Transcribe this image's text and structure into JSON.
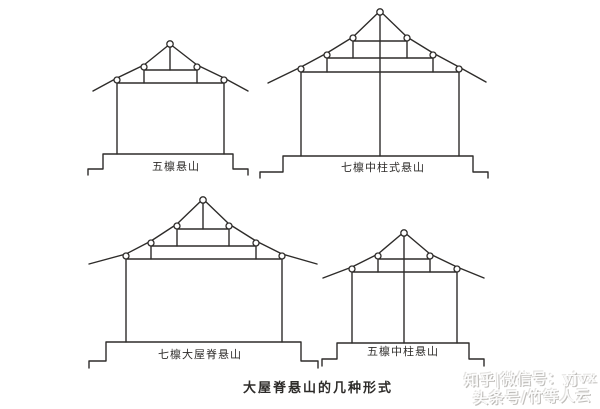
{
  "page": {
    "background": "#ffffff",
    "ink_color": "#2e2c2a",
    "title": "大屋脊悬山的几种形式"
  },
  "watermark": {
    "line1": "知乎|微信号：yjvx",
    "line2": "头条号/竹等人云"
  },
  "figures": [
    {
      "id": "five-purlin-gable",
      "label": "五檩悬山",
      "polylines": [
        {
          "name": "left-rafter",
          "points": [
            [
              93,
              91
            ],
            [
              117,
              78
            ],
            [
              144,
              65
            ],
            [
              170,
              44
            ]
          ]
        },
        {
          "name": "right-rafter",
          "points": [
            [
              170,
              44
            ],
            [
              197,
              65
            ],
            [
              224,
              78
            ],
            [
              248,
              91
            ]
          ]
        },
        {
          "name": "king-post",
          "points": [
            [
              170,
              47
            ],
            [
              170,
              70
            ]
          ]
        },
        {
          "name": "upper-beam",
          "points": [
            [
              144,
              70
            ],
            [
              197,
              70
            ]
          ]
        },
        {
          "name": "upper-post-left",
          "points": [
            [
              144,
              70
            ],
            [
              144,
              83
            ]
          ]
        },
        {
          "name": "upper-post-right",
          "points": [
            [
              197,
              70
            ],
            [
              197,
              83
            ]
          ]
        },
        {
          "name": "main-beam",
          "points": [
            [
              117,
              83
            ],
            [
              224,
              83
            ]
          ]
        },
        {
          "name": "column-left",
          "points": [
            [
              117,
              83
            ],
            [
              117,
              154
            ]
          ]
        },
        {
          "name": "column-right",
          "points": [
            [
              224,
              83
            ],
            [
              224,
              154
            ]
          ]
        },
        {
          "name": "plinth",
          "points": [
            [
              88,
              175
            ],
            [
              88,
              169
            ],
            [
              103,
              169
            ],
            [
              103,
              154
            ],
            [
              233,
              154
            ],
            [
              233,
              169
            ],
            [
              248,
              169
            ],
            [
              248,
              175
            ]
          ]
        }
      ],
      "circles": [
        [
          170,
          44,
          3.2
        ],
        [
          144,
          67,
          3
        ],
        [
          197,
          67,
          3
        ],
        [
          117,
          80,
          3
        ],
        [
          224,
          80,
          3
        ]
      ]
    },
    {
      "id": "seven-purlin-center-column-gable",
      "label": "七檩中柱式悬山",
      "polylines": [
        {
          "name": "left-rafter",
          "points": [
            [
              268,
              83
            ],
            [
              301,
              67
            ],
            [
              327,
              53
            ],
            [
              353,
              37
            ],
            [
              380,
              11
            ]
          ]
        },
        {
          "name": "right-rafter",
          "points": [
            [
              380,
              11
            ],
            [
              407,
              37
            ],
            [
              433,
              53
            ],
            [
              459,
              67
            ],
            [
              486,
              82
            ]
          ]
        },
        {
          "name": "center-column",
          "points": [
            [
              380,
              14
            ],
            [
              380,
              156
            ]
          ]
        },
        {
          "name": "upper-beam",
          "points": [
            [
              353,
              41
            ],
            [
              407,
              41
            ]
          ]
        },
        {
          "name": "upper-post-left",
          "points": [
            [
              353,
              41
            ],
            [
              353,
              58
            ]
          ]
        },
        {
          "name": "upper-post-right",
          "points": [
            [
              407,
              41
            ],
            [
              407,
              58
            ]
          ]
        },
        {
          "name": "middle-beam",
          "points": [
            [
              327,
              58
            ],
            [
              433,
              58
            ]
          ]
        },
        {
          "name": "middle-post-left",
          "points": [
            [
              327,
              58
            ],
            [
              327,
              72
            ]
          ]
        },
        {
          "name": "middle-post-right",
          "points": [
            [
              433,
              58
            ],
            [
              433,
              72
            ]
          ]
        },
        {
          "name": "main-beam",
          "points": [
            [
              301,
              72
            ],
            [
              459,
              72
            ]
          ]
        },
        {
          "name": "column-left",
          "points": [
            [
              301,
              72
            ],
            [
              301,
              156
            ]
          ]
        },
        {
          "name": "column-right",
          "points": [
            [
              459,
              72
            ],
            [
              459,
              156
            ]
          ]
        },
        {
          "name": "plinth",
          "points": [
            [
              260,
              178
            ],
            [
              260,
              172
            ],
            [
              283,
              172
            ],
            [
              283,
              156
            ],
            [
              473,
              156
            ],
            [
              473,
              172
            ],
            [
              488,
              172
            ],
            [
              488,
              178
            ]
          ]
        }
      ],
      "circles": [
        [
          380,
          12,
          3.2
        ],
        [
          353,
          38,
          3
        ],
        [
          407,
          38,
          3
        ],
        [
          327,
          55,
          3
        ],
        [
          433,
          55,
          3
        ],
        [
          301,
          69,
          3
        ],
        [
          459,
          69,
          3
        ]
      ]
    },
    {
      "id": "seven-purlin-big-ridge-gable",
      "label": "七檩大屋脊悬山",
      "polylines": [
        {
          "name": "left-rafter",
          "points": [
            [
              89,
              264
            ],
            [
              126,
              254
            ],
            [
              151,
              241
            ],
            [
              177,
              224
            ],
            [
              203,
              199
            ]
          ]
        },
        {
          "name": "right-rafter",
          "points": [
            [
              203,
              199
            ],
            [
              229,
              224
            ],
            [
              256,
              241
            ],
            [
              282,
              254
            ],
            [
              317,
              264
            ]
          ]
        },
        {
          "name": "king-post",
          "points": [
            [
              203,
              202
            ],
            [
              203,
              229
            ]
          ]
        },
        {
          "name": "upper-beam",
          "points": [
            [
              177,
              229
            ],
            [
              229,
              229
            ]
          ]
        },
        {
          "name": "upper-post-left",
          "points": [
            [
              177,
              229
            ],
            [
              177,
              246
            ]
          ]
        },
        {
          "name": "upper-post-right",
          "points": [
            [
              229,
              229
            ],
            [
              229,
              246
            ]
          ]
        },
        {
          "name": "middle-beam",
          "points": [
            [
              151,
              246
            ],
            [
              256,
              246
            ]
          ]
        },
        {
          "name": "middle-post-left",
          "points": [
            [
              151,
              246
            ],
            [
              151,
              259
            ]
          ]
        },
        {
          "name": "middle-post-right",
          "points": [
            [
              256,
              246
            ],
            [
              256,
              259
            ]
          ]
        },
        {
          "name": "main-beam",
          "points": [
            [
              126,
              259
            ],
            [
              282,
              259
            ]
          ]
        },
        {
          "name": "column-left",
          "points": [
            [
              126,
              259
            ],
            [
              126,
              342
            ]
          ]
        },
        {
          "name": "column-right",
          "points": [
            [
              282,
              259
            ],
            [
              282,
              342
            ]
          ]
        },
        {
          "name": "plinth",
          "points": [
            [
              89,
              368
            ],
            [
              89,
              361
            ],
            [
              106,
              361
            ],
            [
              106,
              342
            ],
            [
              301,
              342
            ],
            [
              301,
              361
            ],
            [
              318,
              361
            ],
            [
              318,
              368
            ]
          ]
        }
      ],
      "circles": [
        [
          203,
          200,
          3.2
        ],
        [
          177,
          226,
          3
        ],
        [
          229,
          226,
          3
        ],
        [
          151,
          243,
          3
        ],
        [
          256,
          243,
          3
        ],
        [
          126,
          256,
          3
        ],
        [
          282,
          256,
          3
        ]
      ]
    },
    {
      "id": "five-purlin-center-column-gable",
      "label": "五檩中柱悬山",
      "polylines": [
        {
          "name": "left-rafter",
          "points": [
            [
              323,
              278
            ],
            [
              352,
              267
            ],
            [
              378,
              254
            ],
            [
              404,
              232
            ]
          ]
        },
        {
          "name": "right-rafter",
          "points": [
            [
              404,
              232
            ],
            [
              430,
              254
            ],
            [
              457,
              267
            ],
            [
              484,
              278
            ]
          ]
        },
        {
          "name": "center-column",
          "points": [
            [
              404,
              235
            ],
            [
              404,
              343
            ]
          ]
        },
        {
          "name": "upper-beam",
          "points": [
            [
              378,
              259
            ],
            [
              430,
              259
            ]
          ]
        },
        {
          "name": "upper-post-left",
          "points": [
            [
              378,
              259
            ],
            [
              378,
              272
            ]
          ]
        },
        {
          "name": "upper-post-right",
          "points": [
            [
              430,
              259
            ],
            [
              430,
              272
            ]
          ]
        },
        {
          "name": "main-beam",
          "points": [
            [
              352,
              272
            ],
            [
              457,
              272
            ]
          ]
        },
        {
          "name": "column-left",
          "points": [
            [
              352,
              272
            ],
            [
              352,
              343
            ]
          ]
        },
        {
          "name": "column-right",
          "points": [
            [
              457,
              272
            ],
            [
              457,
              343
            ]
          ]
        },
        {
          "name": "plinth",
          "points": [
            [
              322,
              366
            ],
            [
              322,
              359
            ],
            [
              337,
              359
            ],
            [
              337,
              343
            ],
            [
              469,
              343
            ],
            [
              469,
              359
            ],
            [
              484,
              359
            ],
            [
              484,
              366
            ]
          ]
        }
      ],
      "circles": [
        [
          404,
          233,
          3.2
        ],
        [
          378,
          256,
          3
        ],
        [
          430,
          256,
          3
        ],
        [
          352,
          269,
          3
        ],
        [
          457,
          269,
          3
        ]
      ]
    }
  ]
}
